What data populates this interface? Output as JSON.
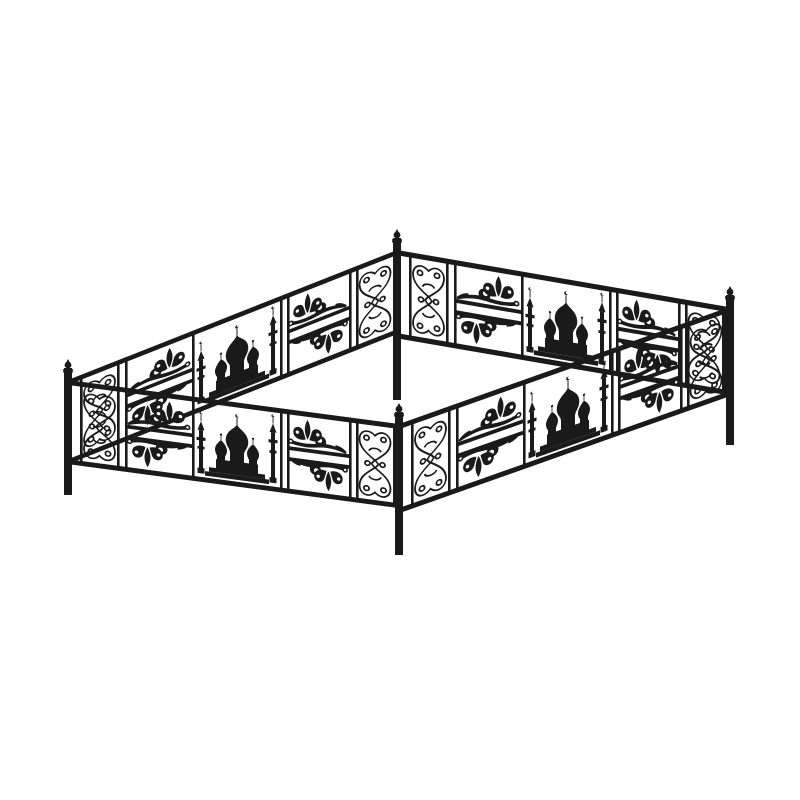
{
  "image": {
    "background_color": "#ffffff",
    "ink_color": "#1a1a1a",
    "description": "Black wrought-iron rectangular grave-plot fence enclosure drawn in perspective on a plain white background",
    "subject": "ornamental metal fence with mosque silhouette panels",
    "motifs": [
      {
        "name": "mosque-silhouette",
        "desc": "mosque with onion domes, crescent finials and two minarets with balconies"
      },
      {
        "name": "butterfly-scroll-ornament",
        "desc": "hourglass-shaped symmetric scrollwork panel beside each corner post"
      },
      {
        "name": "leaf-scroll-ornament",
        "desc": "leafy spiral flourish repeated in mirrored upper and lower sub-panels"
      },
      {
        "name": "corner-post-finial",
        "desc": "small pointed ball cap on top of each corner post"
      }
    ],
    "structure": {
      "sides": 4,
      "corner_posts": 4,
      "rails_per_side": 2,
      "panels_per_side": [
        "butterfly-scroll",
        "leaf-scroll-pair",
        "mosque",
        "leaf-scroll-pair",
        "butterfly-scroll"
      ]
    }
  }
}
